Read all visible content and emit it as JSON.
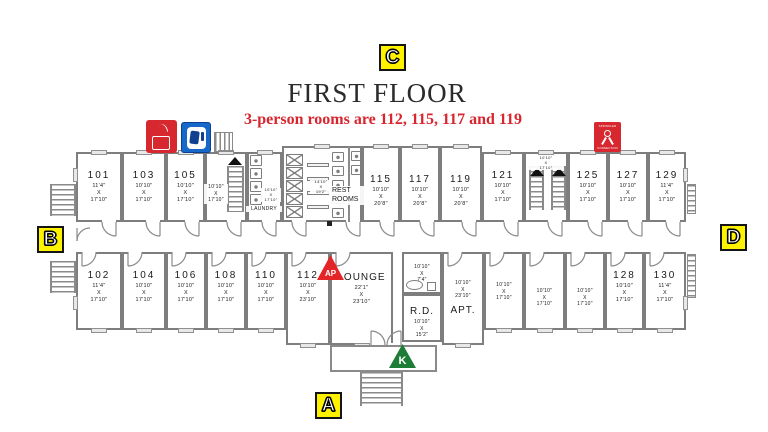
{
  "title": "FIRST FLOOR",
  "subtitle": "3-person rooms are 112, 115, 117 and 119",
  "markers": {
    "a": "A",
    "b": "B",
    "c": "C",
    "d": "D"
  },
  "triangle_markers": {
    "ap": "AP",
    "k": "K"
  },
  "legend": {
    "fire_icon": "fire-extinguisher-cabinet",
    "phone_icon": "emergency-phone",
    "sprinkler_top": "SPRINKLER",
    "sprinkler_bottom": "CONNECTION"
  },
  "core_labels": {
    "rest_line1": "REST",
    "rest_line2": "ROOMS",
    "rest_dims": [
      "14'10\"",
      "X",
      "19'2\""
    ],
    "laundry_label": "LAUNDRY",
    "laundry_dims": [
      "10'10\"",
      "X",
      "17'10\""
    ],
    "west_stair_dims": [
      "10'10\"",
      "X",
      "17'10\""
    ],
    "east_stair_dims": [
      "10'10\"",
      "X",
      "17'10\""
    ]
  },
  "colors": {
    "accent_red": "#d8252e",
    "marker_yellow": "#fff200",
    "triangle_red": "#e42528",
    "triangle_green": "#1d7c36",
    "icon_blue": "#1668c9",
    "icon_red": "#d7282f",
    "wall_gray": "#8a8a8a"
  },
  "cells": [
    {
      "name": "room-101",
      "num": "101",
      "dims": [
        "11'4\"",
        "X",
        "17'10\""
      ],
      "x": 76,
      "y": 152,
      "w": 46,
      "h": 70,
      "row": "t",
      "door": "s"
    },
    {
      "name": "room-103",
      "num": "103",
      "dims": [
        "10'10\"",
        "X",
        "17'10\""
      ],
      "x": 122,
      "y": 152,
      "w": 44,
      "h": 70,
      "row": "t",
      "door": "s"
    },
    {
      "name": "room-105",
      "num": "105",
      "dims": [
        "10'10\"",
        "X",
        "17'10\""
      ],
      "x": 166,
      "y": 152,
      "w": 39,
      "h": 70,
      "row": "t",
      "door": "s"
    },
    {
      "name": "west-stairwell",
      "x": 205,
      "y": 152,
      "w": 42,
      "h": 70,
      "row": "t",
      "door": "s"
    },
    {
      "name": "laundry-room",
      "x": 247,
      "y": 152,
      "w": 35,
      "h": 70,
      "row": "t",
      "door": "s"
    },
    {
      "name": "restroom-core",
      "x": 282,
      "y": 146,
      "w": 80,
      "h": 76,
      "row": "t"
    },
    {
      "name": "room-115",
      "num": "115",
      "dims": [
        "10'10\"",
        "X",
        "20'8\""
      ],
      "x": 362,
      "y": 146,
      "w": 38,
      "h": 76,
      "row": "t",
      "door": "s",
      "pt": 26
    },
    {
      "name": "room-117",
      "num": "117",
      "dims": [
        "10'10\"",
        "X",
        "20'8\""
      ],
      "x": 400,
      "y": 146,
      "w": 40,
      "h": 76,
      "row": "t",
      "door": "s",
      "pt": 26
    },
    {
      "name": "room-119",
      "num": "119",
      "dims": [
        "10'10\"",
        "X",
        "20'8\""
      ],
      "x": 440,
      "y": 146,
      "w": 42,
      "h": 76,
      "row": "t",
      "door": "s",
      "pt": 26
    },
    {
      "name": "room-121",
      "num": "121",
      "dims": [
        "10'10\"",
        "X",
        "17'10\""
      ],
      "x": 482,
      "y": 152,
      "w": 42,
      "h": 70,
      "row": "t",
      "door": "s"
    },
    {
      "name": "east-stairwell",
      "x": 524,
      "y": 152,
      "w": 44,
      "h": 70,
      "row": "t",
      "door": "s"
    },
    {
      "name": "room-125",
      "num": "125",
      "dims": [
        "10'10\"",
        "X",
        "17'10\""
      ],
      "x": 568,
      "y": 152,
      "w": 40,
      "h": 70,
      "row": "t",
      "door": "s"
    },
    {
      "name": "room-127",
      "num": "127",
      "dims": [
        "10'10\"",
        "X",
        "17'10\""
      ],
      "x": 608,
      "y": 152,
      "w": 40,
      "h": 70,
      "row": "t",
      "door": "s"
    },
    {
      "name": "room-129",
      "num": "129",
      "dims": [
        "11'4\"",
        "X",
        "17'10\""
      ],
      "x": 648,
      "y": 152,
      "w": 38,
      "h": 70,
      "row": "t",
      "door": "s"
    },
    {
      "name": "room-102",
      "num": "102",
      "dims": [
        "11'4\"",
        "X",
        "17'10\""
      ],
      "x": 76,
      "y": 252,
      "w": 46,
      "h": 78,
      "row": "b",
      "door": "n"
    },
    {
      "name": "room-104",
      "num": "104",
      "dims": [
        "10'10\"",
        "X",
        "17'10\""
      ],
      "x": 122,
      "y": 252,
      "w": 44,
      "h": 78,
      "row": "b",
      "door": "n"
    },
    {
      "name": "room-106",
      "num": "106",
      "dims": [
        "10'10\"",
        "X",
        "17'10\""
      ],
      "x": 166,
      "y": 252,
      "w": 40,
      "h": 78,
      "row": "b",
      "door": "n"
    },
    {
      "name": "room-108",
      "num": "108",
      "dims": [
        "10'10\"",
        "X",
        "17'10\""
      ],
      "x": 206,
      "y": 252,
      "w": 40,
      "h": 78,
      "row": "b",
      "door": "n"
    },
    {
      "name": "room-110",
      "num": "110",
      "dims": [
        "10'10\"",
        "X",
        "17'10\""
      ],
      "x": 246,
      "y": 252,
      "w": 40,
      "h": 78,
      "row": "b",
      "door": "n"
    },
    {
      "name": "room-112",
      "num": "112",
      "dims": [
        "10'10\"",
        "X",
        "23'10\""
      ],
      "x": 286,
      "y": 252,
      "w": 44,
      "h": 93,
      "row": "b",
      "door": "n"
    },
    {
      "name": "lounge",
      "label": "LOUNGE",
      "labelFirst": true,
      "dims": [
        "22'1\"",
        "X",
        "23'10\""
      ],
      "x": 330,
      "y": 252,
      "w": 63,
      "h": 93,
      "row": "b",
      "door": "n",
      "pt": 18
    },
    {
      "name": "kitchenette",
      "dims": [
        "10'10\"",
        "X",
        "7'4\""
      ],
      "small": true,
      "x": 402,
      "y": 252,
      "w": 40,
      "h": 42,
      "row": "b",
      "win": false,
      "pt": 8
    },
    {
      "name": "rd-room",
      "label": "R.D.",
      "labelFirst": true,
      "dims": [
        "10'10\"",
        "X",
        "15'2\""
      ],
      "small": true,
      "x": 402,
      "y": 294,
      "w": 40,
      "h": 48,
      "row": "b",
      "win": false,
      "pt": 10
    },
    {
      "name": "apartment",
      "label": "APT.",
      "dims": [
        "10'10\"",
        "X",
        "23'10\""
      ],
      "small": true,
      "x": 442,
      "y": 252,
      "w": 42,
      "h": 93,
      "row": "b",
      "door": "n",
      "pt": 24
    },
    {
      "name": "apt-room-1",
      "dims": [
        "10'10\"",
        "X",
        "17'10\""
      ],
      "small": true,
      "x": 484,
      "y": 252,
      "w": 40,
      "h": 78,
      "row": "b",
      "door": "n",
      "pt": 26
    },
    {
      "name": "apt-room-2",
      "dims": [
        "10'10\"",
        "X",
        "17'10\""
      ],
      "small": true,
      "x": 524,
      "y": 252,
      "w": 41,
      "h": 78,
      "row": "b",
      "door": "n",
      "pt": 32
    },
    {
      "name": "apt-room-3",
      "dims": [
        "10'10\"",
        "X",
        "17'10\""
      ],
      "small": true,
      "x": 565,
      "y": 252,
      "w": 40,
      "h": 78,
      "row": "b",
      "door": "n",
      "pt": 32
    },
    {
      "name": "room-128",
      "num": "128",
      "dims": [
        "10'10\"",
        "X",
        "17'10\""
      ],
      "x": 605,
      "y": 252,
      "w": 39,
      "h": 78,
      "row": "b",
      "door": "n"
    },
    {
      "name": "room-130",
      "num": "130",
      "dims": [
        "11'4\"",
        "X",
        "17'10\""
      ],
      "x": 644,
      "y": 252,
      "w": 42,
      "h": 78,
      "row": "b",
      "door": "n"
    }
  ]
}
